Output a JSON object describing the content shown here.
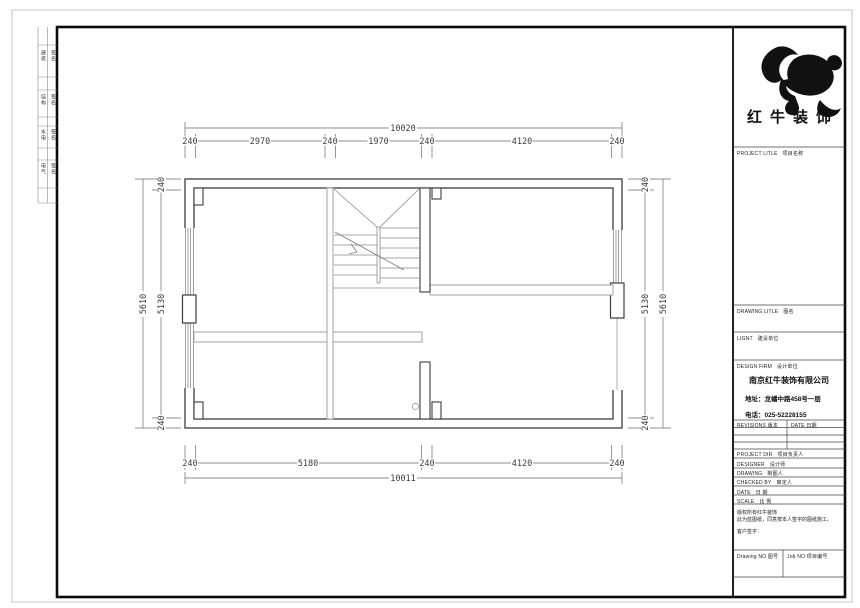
{
  "brand": {
    "name": "红牛装饰"
  },
  "title_block": {
    "project_label_en": "PROJECT LITLE",
    "project_label_zh": "项目名称",
    "drawing_label_en": "DRAWING LITLE",
    "drawing_label_zh": "图名",
    "client_label_en": "LIGNT",
    "client_label_zh": "建设单位",
    "design_firm_label_en": "DESIGN FIRM",
    "design_firm_label_zh": "设计单位",
    "company": {
      "name": "南京红牛装饰有限公司",
      "address": "地址：龙蟠中路458号一层",
      "phone": "电话：025-52228155"
    },
    "revisions_label": "REVISIONS 版本",
    "date_col_label": "DATE 日期",
    "staff_rows": [
      {
        "label_en": "PROJECT DIR",
        "label_zh": "项目负责人"
      },
      {
        "label_en": "DESIGNER",
        "label_zh": "设计师"
      },
      {
        "label_en": "DRAWING",
        "label_zh": "制图人"
      },
      {
        "label_en": "CHECKED BY",
        "label_zh": "审定人"
      },
      {
        "label_en": "DATE",
        "label_zh": "日 期"
      },
      {
        "label_en": "SCALE",
        "label_zh": "比 例"
      }
    ],
    "note_line1": "版权所有红牛装饰",
    "note_line2": "此为蓝图纸，同意按本人签字的图纸施工。",
    "note_line3": "客户签字：",
    "drawing_no_label": "Drawing NO 图号",
    "job_no_label": "Job NO 项目编号"
  },
  "signature_strip": {
    "rows": [
      [
        "建筑",
        "签名"
      ],
      [
        "结构",
        "签名"
      ],
      [
        "水电",
        "签名"
      ],
      [
        "电气",
        "签名"
      ]
    ]
  },
  "dimensions": {
    "top": {
      "total": "10020",
      "segments": [
        "240",
        "2970",
        "240",
        "1970",
        "240",
        "4120",
        "240"
      ]
    },
    "bottom": {
      "total": "10011",
      "segments": [
        "240",
        "5180",
        "240",
        "4120",
        "240"
      ]
    },
    "left": {
      "total": "5610",
      "segments": [
        "240",
        "5130",
        "240"
      ]
    },
    "right": {
      "total": "5610",
      "segments": [
        "240",
        "5130",
        "240"
      ]
    }
  }
}
